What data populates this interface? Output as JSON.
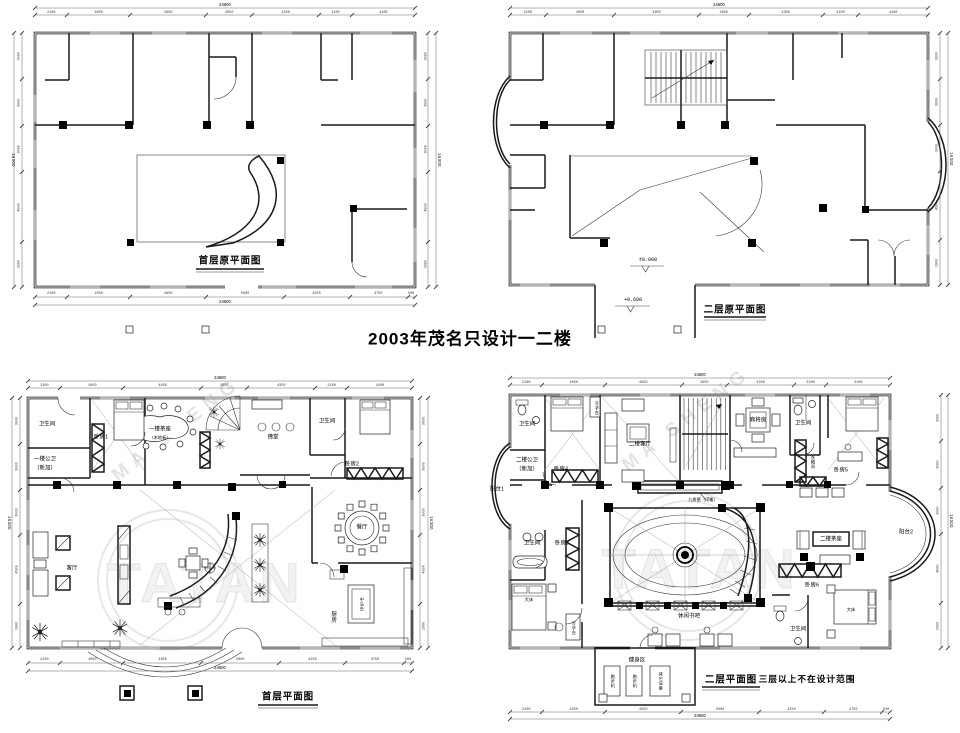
{
  "title_note": "2003年茂名只设计一二楼",
  "dims": {
    "overall_width": "24600",
    "overall_height": "16300",
    "top_segments": [
      "2100",
      "4050",
      "4950",
      "2950",
      "4350",
      "2100",
      "4100"
    ],
    "bottom_segments": [
      "2100",
      "4050",
      "4950",
      "5000",
      "4250",
      "3750",
      "500"
    ],
    "side_segments": [
      "3000",
      "3000",
      "3000",
      "4500",
      "2900"
    ]
  },
  "plan_original_first": {
    "caption": "首层原平面图"
  },
  "plan_original_second": {
    "caption": "二层原平面图",
    "elevation_main": "±0.000",
    "elevation_entry": "+0.600"
  },
  "plan_first": {
    "caption": "首层平面图",
    "rooms": {
      "bathroom_1": "卫生间",
      "bedroom_1": "卧房1",
      "public_wc_line1": "一楼公卫",
      "public_wc_line2": "（新加）",
      "tea_area": "一楼茶座",
      "tea_area_sub": "（木地板）",
      "buddha_hall": "佛堂",
      "bathroom_2": "卫生间",
      "bedroom_2": "卧房2",
      "dining": "餐厅",
      "living": "客厅",
      "kitchen": "厨房",
      "island": "中岛台"
    }
  },
  "plan_second": {
    "caption": "二层平面图",
    "scope_note": "三层以上不在设计范围",
    "rooms": {
      "bathroom_top": "卫生间",
      "public_wc_line1": "二楼公卫",
      "public_wc_line2": "（新加）",
      "bedroom_4": "卧房4",
      "desk_1": "写字台",
      "living_2f": "二楼客厅",
      "mahjong": "麻将房",
      "bathroom_mid": "卫生间",
      "cloakroom": "衣帽间",
      "bedroom_5": "卧房5",
      "balcony_1": "阳台1",
      "bathroom_3": "卫生间",
      "bedroom_3": "卧房3",
      "bed_3": "大床",
      "desk_2": "写字台",
      "nine_fish_wall": "九鱼壁（浮雕）",
      "book_bar": "休闲书吧",
      "fitness": "健身区",
      "treadmill": "跑步机",
      "other_equipment": "其它设备",
      "tea_area_2f": "二楼茶座",
      "bedroom_6": "卧房6",
      "bathroom_6": "卫生间",
      "bed_6": "大床",
      "balcony_2": "阳台2"
    }
  },
  "watermark": {
    "brand_arc": "MA SHENG",
    "brand_main": "TATAN"
  }
}
